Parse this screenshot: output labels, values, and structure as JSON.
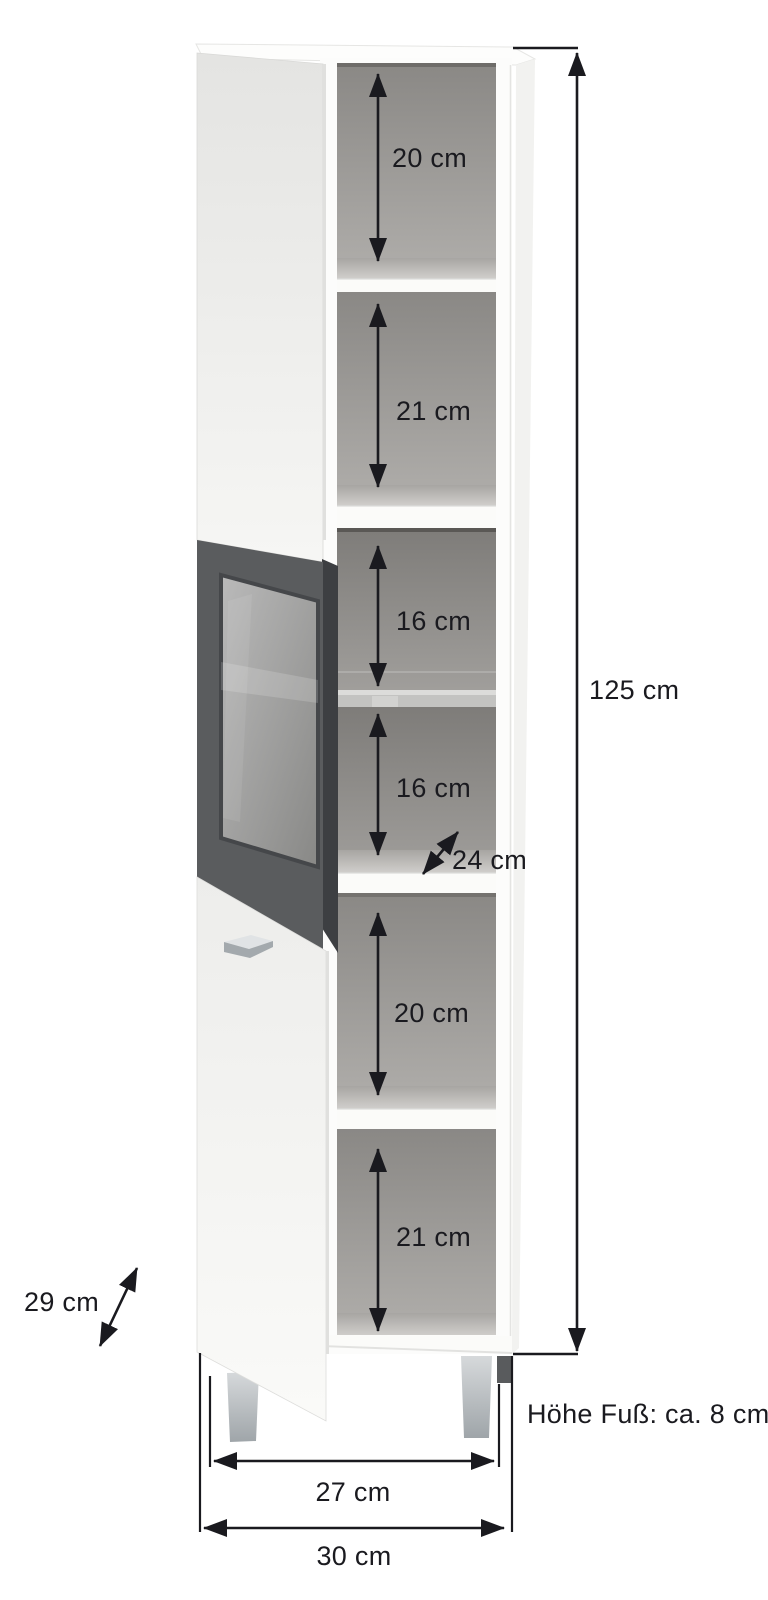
{
  "page": {
    "type": "product-dimension-diagram",
    "subject": "tall bathroom cabinet with open shelves, glass door and two panel doors",
    "background": "#ffffff"
  },
  "measurements": {
    "compartments": [
      "20 cm",
      "21 cm",
      "16 cm",
      "16 cm",
      "20 cm",
      "21 cm"
    ],
    "inner_depth": "24 cm",
    "outer_depth": "29 cm",
    "total_height": "125 cm",
    "inner_width": "27 cm",
    "outer_width": "30 cm",
    "foot_height_note": "Höhe Fuß: ca. 8 cm"
  },
  "colors": {
    "annotation": "#1a1a1f",
    "cabinet_white": "#fbfbf9",
    "interior_gray": "#8a8885",
    "glass_frame": "#5a5c5e",
    "metal": "#a9afb3"
  }
}
